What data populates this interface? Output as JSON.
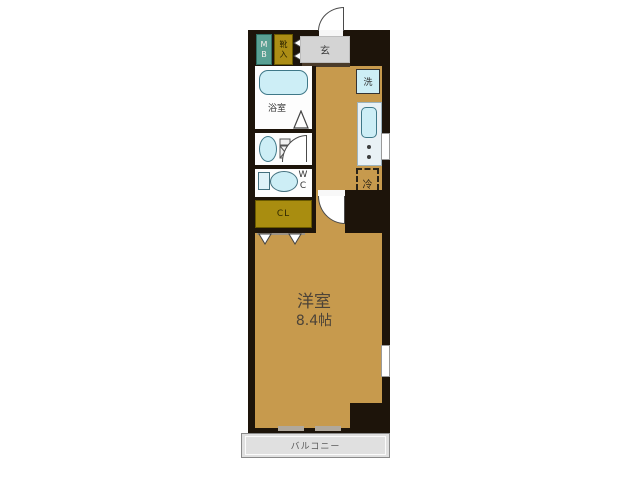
{
  "plan": {
    "title": "1K apartment floor plan",
    "meter_box": {
      "label": "MB"
    },
    "shoe_box": {
      "label": "靴入"
    },
    "entrance": {
      "label": "玄"
    },
    "bathroom": {
      "label": "浴室"
    },
    "washer_space": {
      "label": "洗"
    },
    "wc": {
      "label": "WC"
    },
    "closet": {
      "label": "CL"
    },
    "fridge_space": {
      "label": "冷"
    },
    "main_room": {
      "label": "洋室",
      "size": "8.4帖"
    },
    "balcony": {
      "label": "バルコニー"
    }
  },
  "colors": {
    "floor_tan": "#c79a4d",
    "wall_black": "#1d140a",
    "fixture_cyan": "#cdeef6",
    "fixture_border": "#3f7888",
    "closet_gold": "#a98d10",
    "meter_teal": "#5aa093",
    "entrance_gray": "#d4d4d4",
    "balcony_gray": "#e0e0e0"
  }
}
